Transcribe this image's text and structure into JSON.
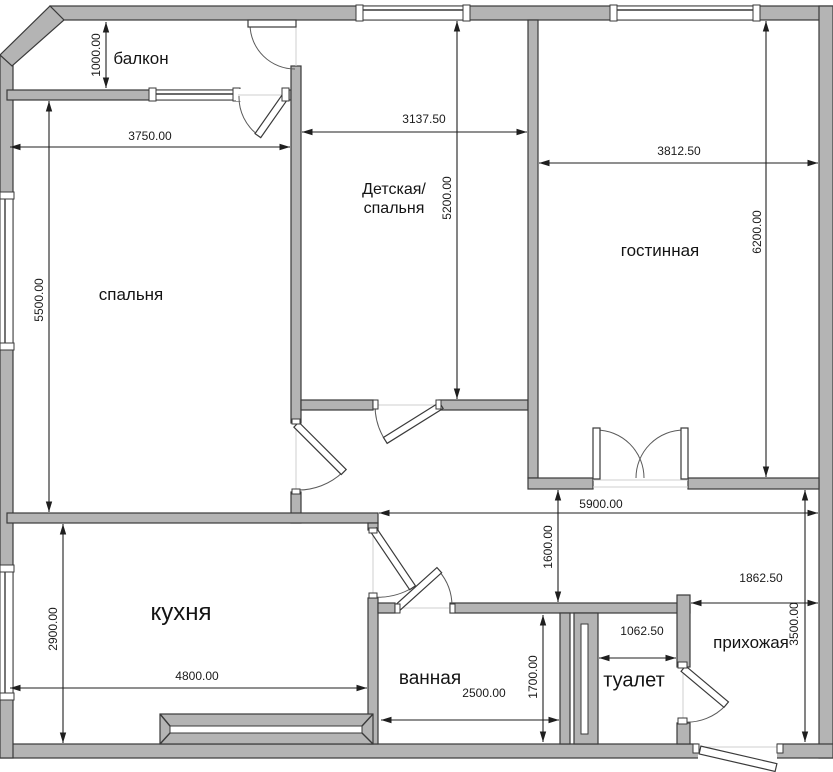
{
  "rooms": {
    "balcony": "балкон",
    "bedroom": "спальня",
    "nursery_line1": "Детская/",
    "nursery_line2": "спальня",
    "living": "гостинная",
    "kitchen": "кухня",
    "bathroom": "ванная",
    "toilet": "туалет",
    "hallway": "прихожая"
  },
  "dims": {
    "balcony_depth": "1000.00",
    "bedroom_width": "3750.00",
    "nursery_width": "3137.50",
    "living_width": "3812.50",
    "nursery_height": "5200.00",
    "living_height": "6200.00",
    "bedroom_height": "5500.00",
    "corridor_width": "5900.00",
    "corridor_height": "1600.00",
    "kitchen_height": "2900.00",
    "kitchen_width": "4800.00",
    "bathroom_width": "2500.00",
    "bathroom_height": "1700.00",
    "toilet_width": "1062.50",
    "hallway_width": "1862.50",
    "hallway_height": "3500.00"
  },
  "colors": {
    "wall_fill": "#b4b4b4",
    "wall_outline": "#3a3a3a",
    "dimension_line": "#1f1f1f",
    "background": "#ffffff"
  }
}
